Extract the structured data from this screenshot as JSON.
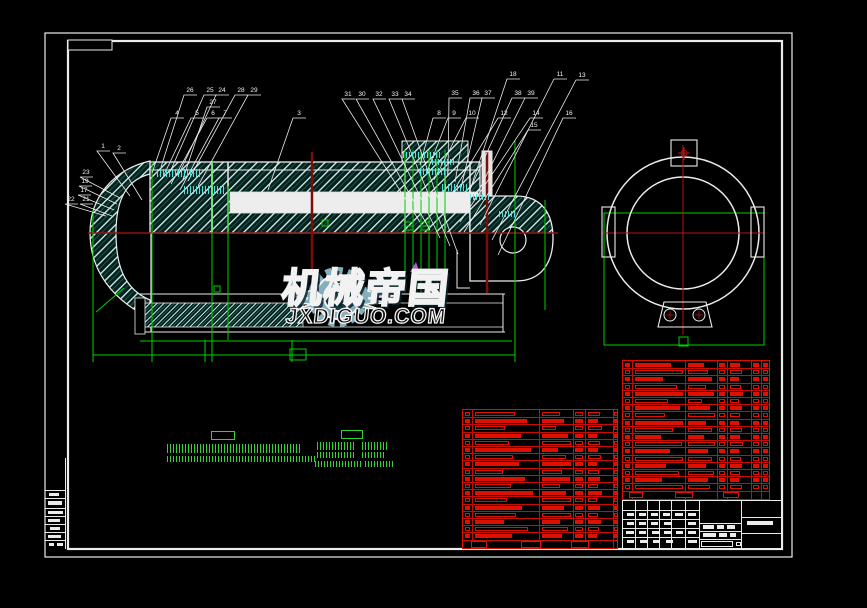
{
  "canvas": {
    "width": 867,
    "height": 608,
    "background": "#000000"
  },
  "colors": {
    "outline_white": "#ececec",
    "cad_green": "#00cf00",
    "centerline_red": "#8e1410",
    "bright_red": "#bb1212",
    "bom_red": "#dd1000",
    "cyan_dim_text": "#55eae6",
    "magenta_leader": "#bf4fe8",
    "hatch_teal": "#1e6a60",
    "watermark_steel": "#7fa9ba"
  },
  "watermark": {
    "brand": "机械帝国",
    "site": "JXDIGUO.COM",
    "initials": "JX"
  },
  "balloons": [
    {
      "n": "26",
      "x": 189,
      "y": 92,
      "tx": 161,
      "ty": 167
    },
    {
      "n": "25",
      "x": 209,
      "y": 92,
      "tx": 170,
      "ty": 172
    },
    {
      "n": "24",
      "x": 221,
      "y": 92,
      "tx": 178,
      "ty": 176
    },
    {
      "n": "28",
      "x": 240,
      "y": 92,
      "tx": 188,
      "ty": 181
    },
    {
      "n": "29",
      "x": 253,
      "y": 92,
      "tx": 198,
      "ty": 186
    },
    {
      "n": "27",
      "x": 212,
      "y": 104,
      "tx": 183,
      "ty": 179
    },
    {
      "n": "4",
      "x": 176,
      "y": 115,
      "tx": 152,
      "ty": 173
    },
    {
      "n": "5",
      "x": 196,
      "y": 115,
      "tx": 162,
      "ty": 179
    },
    {
      "n": "6",
      "x": 212,
      "y": 115,
      "tx": 171,
      "ty": 184
    },
    {
      "n": "7",
      "x": 224,
      "y": 115,
      "tx": 180,
      "ty": 190
    },
    {
      "n": "1",
      "x": 102,
      "y": 148,
      "tx": 130,
      "ty": 196
    },
    {
      "n": "2",
      "x": 118,
      "y": 150,
      "tx": 142,
      "ty": 200
    },
    {
      "n": "23",
      "x": 85,
      "y": 174,
      "tx": 120,
      "ty": 198
    },
    {
      "n": "19",
      "x": 84,
      "y": 183,
      "tx": 117,
      "ty": 204
    },
    {
      "n": "17",
      "x": 83,
      "y": 192,
      "tx": 114,
      "ty": 210
    },
    {
      "n": "22",
      "x": 70,
      "y": 201,
      "tx": 106,
      "ty": 216
    },
    {
      "n": "21",
      "x": 85,
      "y": 201,
      "tx": 112,
      "ty": 216
    },
    {
      "n": "3",
      "x": 298,
      "y": 115,
      "tx": 268,
      "ty": 190
    },
    {
      "n": "31",
      "x": 347,
      "y": 96,
      "tx": 420,
      "ty": 222
    },
    {
      "n": "30",
      "x": 361,
      "y": 96,
      "tx": 430,
      "ty": 230
    },
    {
      "n": "32",
      "x": 378,
      "y": 96,
      "tx": 440,
      "ty": 238
    },
    {
      "n": "33",
      "x": 394,
      "y": 96,
      "tx": 450,
      "ty": 246
    },
    {
      "n": "34",
      "x": 407,
      "y": 96,
      "tx": 458,
      "ty": 254
    },
    {
      "n": "35",
      "x": 454,
      "y": 95,
      "tx": 448,
      "ty": 175
    },
    {
      "n": "36",
      "x": 475,
      "y": 95,
      "tx": 455,
      "ty": 182
    },
    {
      "n": "37",
      "x": 487,
      "y": 95,
      "tx": 461,
      "ty": 188
    },
    {
      "n": "38",
      "x": 517,
      "y": 95,
      "tx": 468,
      "ty": 194
    },
    {
      "n": "39",
      "x": 530,
      "y": 95,
      "tx": 474,
      "ty": 200
    },
    {
      "n": "18",
      "x": 512,
      "y": 76,
      "tx": 465,
      "ty": 205
    },
    {
      "n": "11",
      "x": 559,
      "y": 76,
      "tx": 480,
      "ty": 225
    },
    {
      "n": "13",
      "x": 581,
      "y": 77,
      "tx": 492,
      "ty": 240
    },
    {
      "n": "8",
      "x": 438,
      "y": 115,
      "tx": 420,
      "ty": 165
    },
    {
      "n": "9",
      "x": 453,
      "y": 115,
      "tx": 427,
      "ty": 172
    },
    {
      "n": "10",
      "x": 471,
      "y": 115,
      "tx": 434,
      "ty": 180
    },
    {
      "n": "12",
      "x": 503,
      "y": 115,
      "tx": 448,
      "ty": 200
    },
    {
      "n": "14",
      "x": 535,
      "y": 115,
      "tx": 460,
      "ty": 222
    },
    {
      "n": "15",
      "x": 533,
      "y": 127,
      "tx": 464,
      "ty": 232
    },
    {
      "n": "16",
      "x": 568,
      "y": 115,
      "tx": 498,
      "ty": 255
    }
  ],
  "cyan_labels": [
    [
      157,
      169,
      44,
      8
    ],
    [
      184,
      186,
      40,
      8
    ],
    [
      403,
      152,
      38,
      6
    ],
    [
      420,
      168,
      28,
      7
    ],
    [
      442,
      184,
      26,
      7
    ],
    [
      470,
      194,
      20,
      6
    ],
    [
      432,
      159,
      22,
      6
    ],
    [
      499,
      211,
      16,
      6
    ]
  ],
  "notes": {
    "blocks": [
      {
        "head": [
          211,
          431,
          24,
          9
        ],
        "lines": [
          [
            167,
            444,
            135,
            9
          ],
          [
            167,
            456,
            148,
            6
          ]
        ]
      },
      {
        "head": [
          341,
          430,
          22,
          9
        ],
        "lines": [
          [
            317,
            442,
            38,
            8
          ],
          [
            362,
            442,
            26,
            8
          ],
          [
            317,
            452,
            38,
            6
          ],
          [
            362,
            452,
            22,
            6
          ],
          [
            315,
            461,
            46,
            6
          ],
          [
            365,
            461,
            28,
            6
          ]
        ]
      }
    ]
  },
  "rev_strip": {
    "x": 45,
    "y": 458,
    "w": 21,
    "h": 91,
    "h_lines": [
      32,
      40,
      50,
      58,
      66,
      74,
      82
    ],
    "blobs": [
      [
        4,
        35,
        10,
        3
      ],
      [
        3,
        43,
        14,
        4
      ],
      [
        3,
        53,
        15,
        3
      ],
      [
        3,
        61,
        12,
        3
      ],
      [
        5,
        69,
        10,
        3
      ],
      [
        3,
        77,
        13,
        3
      ],
      [
        4,
        85,
        5,
        3
      ],
      [
        12,
        85,
        6,
        3
      ]
    ]
  },
  "bom_tables": [
    {
      "x": 462,
      "y": 409,
      "w": 156,
      "h": 140,
      "rowH": 7.2,
      "cols": [
        9,
        76,
        110,
        122,
        150
      ],
      "cells": [
        {
          "x": 12,
          "src": 0,
          "max": 62
        },
        {
          "x": 79,
          "src": 1,
          "max": 29
        },
        {
          "x": 112,
          "w": 8
        },
        {
          "x": 125,
          "src": 3,
          "max": 23
        },
        {
          "x": 151,
          "w": 4
        }
      ],
      "rows": [
        [
          40,
          18,
          1,
          12
        ],
        [
          52,
          22,
          0,
          10
        ],
        [
          30,
          14,
          1,
          14
        ],
        [
          46,
          26,
          0,
          9
        ],
        [
          34,
          30,
          1,
          12
        ],
        [
          56,
          16,
          0,
          10
        ],
        [
          38,
          24,
          1,
          13
        ],
        [
          44,
          34,
          0,
          9
        ],
        [
          28,
          20,
          1,
          11
        ],
        [
          50,
          28,
          0,
          12
        ],
        [
          36,
          18,
          1,
          10
        ],
        [
          58,
          24,
          0,
          14
        ],
        [
          32,
          30,
          1,
          9
        ],
        [
          47,
          22,
          0,
          12
        ],
        [
          41,
          36,
          1,
          10
        ],
        [
          29,
          18,
          0,
          13
        ],
        [
          53,
          26,
          1,
          11
        ],
        [
          37,
          20,
          0,
          9
        ]
      ],
      "footer": [
        [
          8,
          131,
          16,
          7
        ],
        [
          58,
          131,
          20,
          7
        ],
        [
          108,
          131,
          18,
          7
        ]
      ]
    },
    {
      "x": 622,
      "y": 360,
      "w": 148,
      "h": 140,
      "rowH": 7.2,
      "cols": [
        9,
        62,
        94,
        104,
        128,
        138
      ],
      "cells": [
        {
          "x": 12,
          "src": 0,
          "max": 48
        },
        {
          "x": 65,
          "src": 1,
          "max": 27
        },
        {
          "x": 96,
          "w": 6
        },
        {
          "x": 107,
          "src": 3,
          "max": 19
        },
        {
          "x": 130,
          "w": 6
        },
        {
          "x": 140,
          "w": 5
        }
      ],
      "rows": [
        [
          36,
          16,
          0,
          10
        ],
        [
          48,
          20,
          1,
          12
        ],
        [
          28,
          24,
          0,
          9
        ],
        [
          42,
          18,
          1,
          11
        ],
        [
          55,
          26,
          0,
          13
        ],
        [
          33,
          14,
          1,
          9
        ],
        [
          45,
          22,
          0,
          12
        ],
        [
          30,
          28,
          1,
          10
        ],
        [
          51,
          18,
          0,
          9
        ],
        [
          38,
          24,
          1,
          12
        ],
        [
          26,
          16,
          0,
          10
        ],
        [
          47,
          30,
          1,
          13
        ],
        [
          35,
          20,
          0,
          9
        ],
        [
          53,
          24,
          1,
          11
        ],
        [
          31,
          18,
          0,
          12
        ],
        [
          44,
          26,
          1,
          10
        ],
        [
          27,
          20,
          0,
          9
        ],
        [
          49,
          22,
          1,
          12
        ]
      ],
      "footer": [
        [
          6,
          131,
          14,
          6
        ],
        [
          52,
          131,
          18,
          6
        ],
        [
          100,
          131,
          16,
          6
        ]
      ]
    }
  ],
  "title_block": {
    "x": 622,
    "y": 500,
    "w": 160,
    "h": 49,
    "v_lines": [
      12,
      24,
      36,
      48,
      62,
      76,
      118
    ],
    "h_left": [
      9,
      18,
      27,
      36
    ],
    "h_mid": [
      22,
      30,
      38
    ],
    "h_right": [
      16,
      32
    ],
    "blobs": [
      [
        4,
        12,
        7,
        3
      ],
      [
        16,
        12,
        7,
        3
      ],
      [
        28,
        12,
        7,
        3
      ],
      [
        40,
        12,
        7,
        3
      ],
      [
        52,
        12,
        8,
        3
      ],
      [
        65,
        12,
        8,
        3
      ],
      [
        4,
        21,
        7,
        3
      ],
      [
        16,
        21,
        7,
        3
      ],
      [
        28,
        21,
        7,
        3
      ],
      [
        41,
        21,
        8,
        3
      ],
      [
        65,
        21,
        8,
        3
      ],
      [
        3,
        30,
        8,
        3
      ],
      [
        16,
        30,
        7,
        3
      ],
      [
        29,
        30,
        7,
        3
      ],
      [
        41,
        30,
        7,
        3
      ],
      [
        53,
        30,
        7,
        3
      ],
      [
        65,
        30,
        8,
        3
      ],
      [
        4,
        39,
        7,
        3
      ],
      [
        17,
        39,
        7,
        3
      ],
      [
        30,
        39,
        7,
        3
      ],
      [
        43,
        39,
        7,
        3
      ],
      [
        65,
        39,
        9,
        3
      ],
      [
        80,
        24,
        11,
        4
      ],
      [
        94,
        24,
        7,
        4
      ],
      [
        104,
        24,
        8,
        4
      ],
      [
        80,
        32,
        13,
        4
      ],
      [
        96,
        32,
        8,
        4
      ],
      [
        107,
        32,
        6,
        4
      ],
      [
        124,
        20,
        26,
        4
      ]
    ],
    "boxes": [
      [
        78,
        40,
        32,
        6
      ],
      [
        113,
        41,
        5,
        4
      ]
    ]
  }
}
